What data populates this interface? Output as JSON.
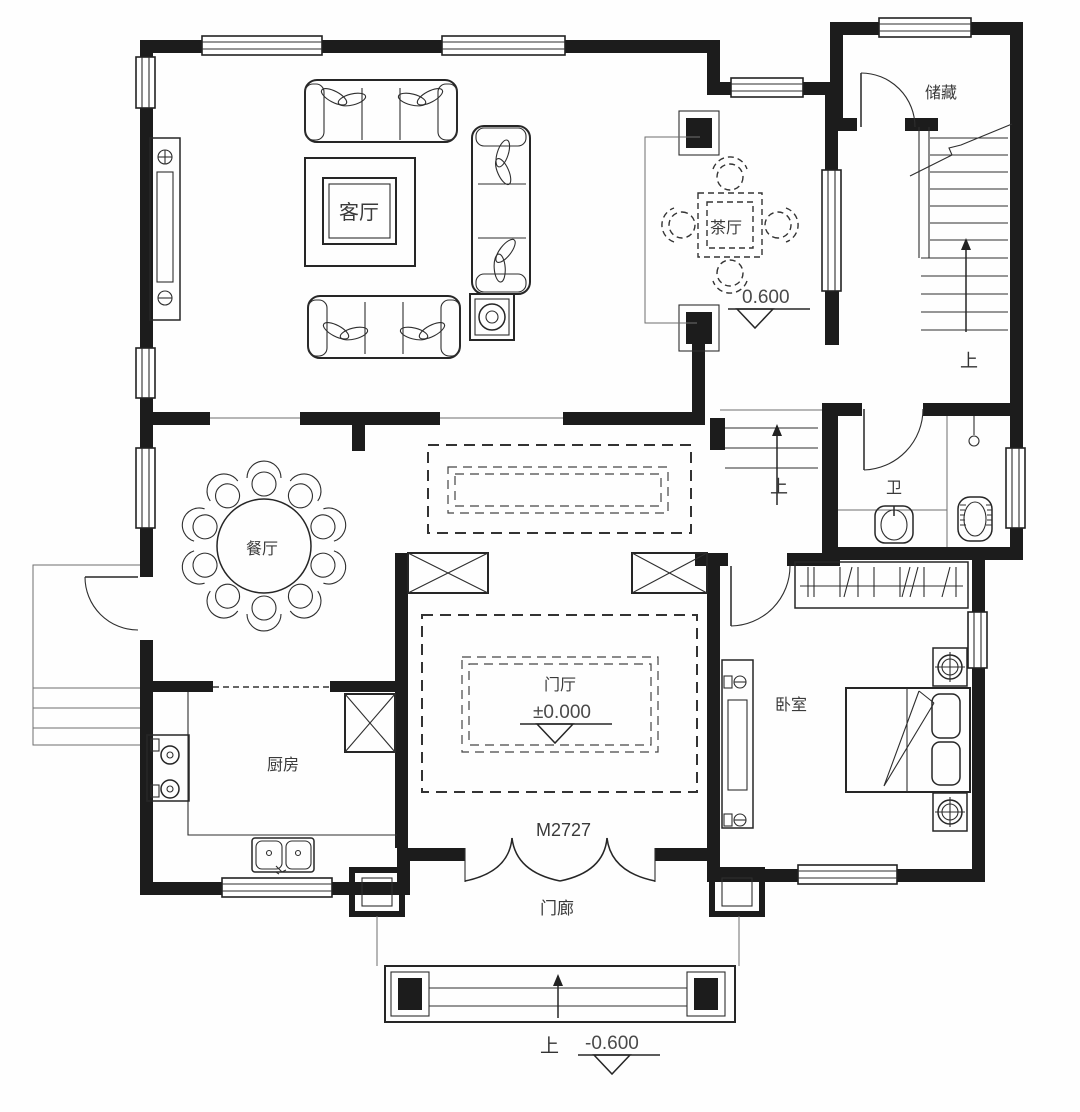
{
  "rooms": {
    "living": "客厅",
    "tea": "茶厅",
    "storage": "储藏",
    "dining": "餐厅",
    "kitchen": "厨房",
    "hall": "门厅",
    "bedroom": "卧室",
    "bath": "卫",
    "porch": "门廊"
  },
  "elevations": {
    "tea": "0.600",
    "hall": "±0.000",
    "porch": "-0.600"
  },
  "labels": {
    "door": "M2727",
    "up": "上"
  },
  "colors": {
    "wall": "#1c1c1c",
    "line": "#262626",
    "text": "#3a3a3a",
    "background": "#fefefe"
  }
}
